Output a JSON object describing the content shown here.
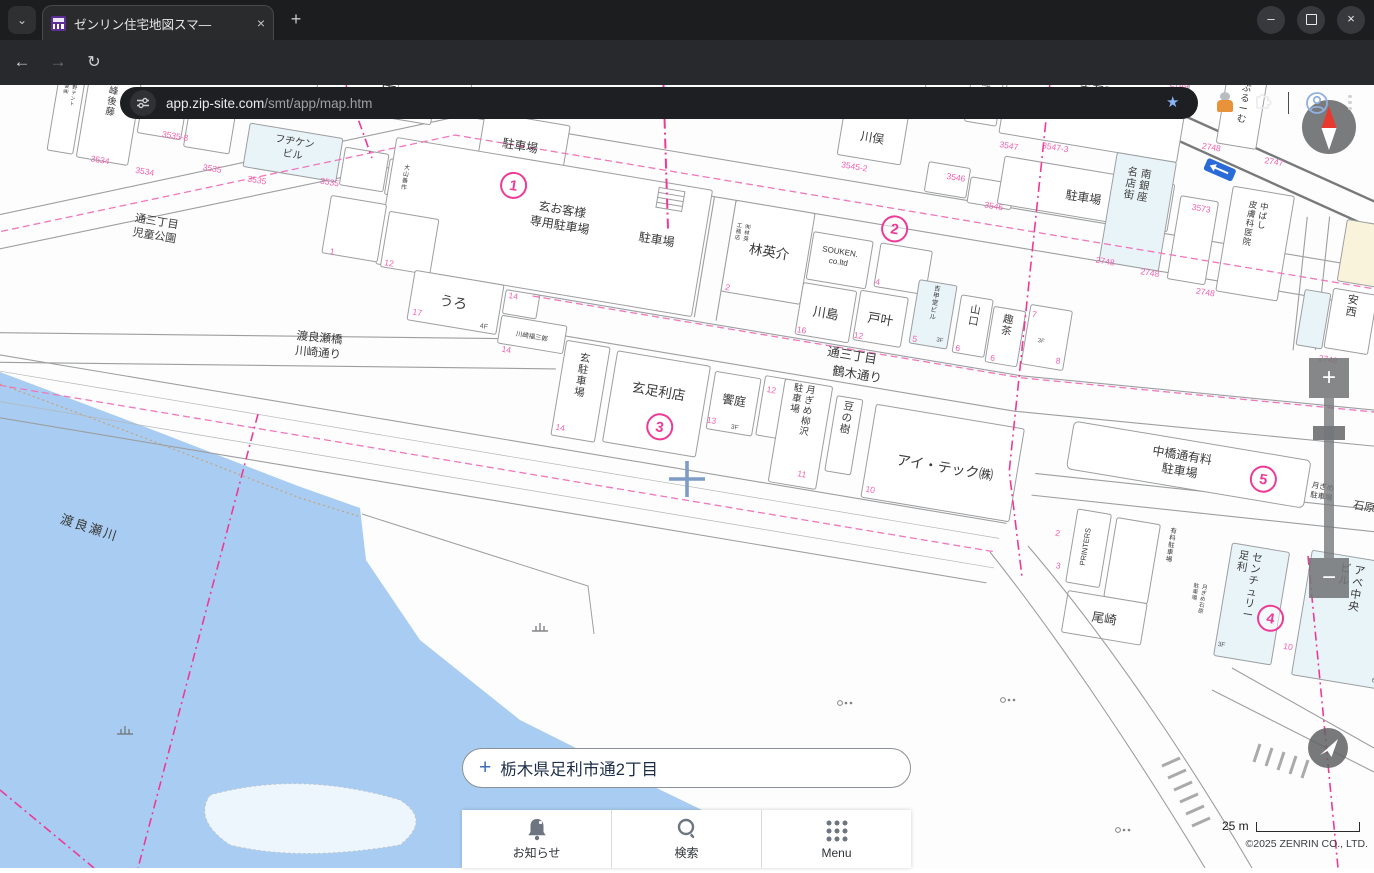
{
  "browser": {
    "tab_title": "ゼンリン住宅地図スマ—",
    "tab_close": "×",
    "new_tab": "+",
    "url_domain": "app.zip-site.com",
    "url_path": "/smt/app/map.htm",
    "window": {
      "minimize": "—",
      "close": "×"
    }
  },
  "search": {
    "plus": "+",
    "address": "栃木県足利市通2丁目"
  },
  "toolbar": {
    "notice": "お知らせ",
    "search": "検索",
    "menu": "Menu"
  },
  "controls": {
    "zoom_in": "+",
    "zoom_out": "−",
    "scale": "25 m",
    "copyright": "©2025 ZENRIN CO., LTD."
  },
  "map": {
    "colors": {
      "parcel": "#f35fae",
      "boundary": "#ee3a97",
      "river": "#a9cdf2",
      "building_blue": "#e9f4f8",
      "building_cream": "#faf3dc",
      "road": "#9c9ea0",
      "crosshair": "#7e9cc6"
    },
    "labels": [
      {
        "t": "三田",
        "x": 321,
        "y": 152,
        "s": 16
      },
      {
        "t": "峰後藤",
        "x": 58,
        "y": 194,
        "s": 9.5,
        "v": 1
      },
      {
        "t": "水野テント\n商会㈱",
        "x": 19,
        "y": 190,
        "s": 5,
        "v": 1
      },
      {
        "t": "フヂケン\nビル",
        "x": 245,
        "y": 214,
        "s": 10
      },
      {
        "t": "大山善作",
        "x": 360,
        "y": 220,
        "s": 6,
        "v": 1
      },
      {
        "t": "通三丁目\n児童公園",
        "x": 122,
        "y": 316,
        "s": 11
      },
      {
        "t": "イシイ",
        "x": 372,
        "y": 146,
        "s": 11
      },
      {
        "t": "3F",
        "x": 402,
        "y": 154,
        "s": 6.5,
        "c": "#555"
      },
      {
        "t": "駐車場",
        "x": 468,
        "y": 182,
        "s": 12
      },
      {
        "t": "玄お客様\n専用駐車場",
        "x": 520,
        "y": 238,
        "s": 12
      },
      {
        "t": "駐車場",
        "x": 618,
        "y": 252,
        "s": 12
      },
      {
        "t": "うろ",
        "x": 428,
        "y": 348,
        "s": 14
      },
      {
        "t": "4F",
        "x": 462,
        "y": 364,
        "s": 7,
        "c": "#555"
      },
      {
        "t": "川崎福三郎",
        "x": 511,
        "y": 366,
        "s": 6.5
      },
      {
        "t": "玄駐車場",
        "x": 567,
        "y": 380,
        "s": 10.5,
        "v": 1
      },
      {
        "t": "林英介",
        "x": 731,
        "y": 246,
        "s": 13.5
      },
      {
        "t": "㈲林英\n工務店",
        "x": 706,
        "y": 222,
        "s": 5.5,
        "v": 1
      },
      {
        "t": "SOUKEN.\nco.ltd",
        "x": 801,
        "y": 232,
        "s": 8
      },
      {
        "t": "川島",
        "x": 797,
        "y": 297,
        "s": 13
      },
      {
        "t": "戸叶",
        "x": 852,
        "y": 294,
        "s": 13
      },
      {
        "t": "吉甲堂ビル",
        "x": 903,
        "y": 252,
        "s": 6.5,
        "v": 1
      },
      {
        "t": "3F",
        "x": 914,
        "y": 302,
        "s": 6,
        "c": "#555"
      },
      {
        "t": "山口",
        "x": 944,
        "y": 268,
        "s": 10.5,
        "v": 1
      },
      {
        "t": "趣茶",
        "x": 978,
        "y": 272,
        "s": 10.5,
        "v": 1
      },
      {
        "t": "3F",
        "x": 1014,
        "y": 286,
        "s": 6,
        "c": "#555"
      },
      {
        "t": "通三丁目",
        "x": 830,
        "y": 334,
        "s": 12.5
      },
      {
        "t": "鶴木通り",
        "x": 838,
        "y": 352,
        "s": 12.5
      },
      {
        "t": "玄足利店",
        "x": 645,
        "y": 402,
        "s": 13.5
      },
      {
        "t": "饗庭",
        "x": 721,
        "y": 398,
        "s": 12
      },
      {
        "t": "月ぎめ柳沢\n駐車場",
        "x": 795,
        "y": 374,
        "s": 9.5,
        "v": 1
      },
      {
        "t": "豆の樹",
        "x": 835,
        "y": 384,
        "s": 10.5,
        "v": 1
      },
      {
        "t": "アイ・テック㈱",
        "x": 940,
        "y": 430,
        "s": 14
      },
      {
        "t": "渡良瀬橋\n川崎通り",
        "x": 302,
        "y": 404,
        "s": 11.5,
        "r": -4
      },
      {
        "t": "JYU",
        "x": 881,
        "y": 44,
        "s": 10
      },
      {
        "t": "赤石屋",
        "x": 918,
        "y": 22,
        "s": 9,
        "v": 1
      },
      {
        "t": "赤石屋\n駐車場",
        "x": 1028,
        "y": 32,
        "s": 12
      },
      {
        "t": "川俣",
        "x": 814,
        "y": 116,
        "s": 12
      },
      {
        "t": "駐車場",
        "x": 1032,
        "y": 140,
        "s": 12
      },
      {
        "t": "ぶるーむ",
        "x": 1175,
        "y": 4,
        "s": 9.5,
        "v": 1
      },
      {
        "t": "南銀座\n名店街",
        "x": 1090,
        "y": 106,
        "s": 10.5,
        "v": 1
      },
      {
        "t": "中ばし\n皮膚科医院",
        "x": 1212,
        "y": 118,
        "s": 8.5,
        "v": 1
      },
      {
        "t": "秋山\n医院",
        "x": 1342,
        "y": 126,
        "s": 8,
        "v": 1
      },
      {
        "t": "安西",
        "x": 1315,
        "y": 196,
        "s": 11,
        "v": 1
      },
      {
        "t": "中橋通有料\n駐車場",
        "x": 1172,
        "y": 378,
        "s": 12
      },
      {
        "t": "月ぎめ\n駐車場",
        "x": 1316,
        "y": 384,
        "s": 7.5
      },
      {
        "t": "石原",
        "x": 1360,
        "y": 398,
        "s": 11
      },
      {
        "t": "PRINTERS",
        "x": 1094,
        "y": 480,
        "s": 7.5,
        "r": -90
      },
      {
        "t": "有料駐車場",
        "x": 1176,
        "y": 452,
        "s": 6.5,
        "v": 1
      },
      {
        "t": "尾崎",
        "x": 1122,
        "y": 552,
        "s": 12.5
      },
      {
        "t": "月ぎめ石原\n駐車場",
        "x": 1216,
        "y": 502,
        "s": 5.5,
        "v": 1
      },
      {
        "t": "センチュリー\n足利",
        "x": 1263,
        "y": 466,
        "s": 10.5,
        "v": 1
      },
      {
        "t": "3F",
        "x": 1242,
        "y": 556,
        "s": 6.5,
        "c": "#555"
      },
      {
        "t": "アベ中央\nビル",
        "x": 1366,
        "y": 462,
        "s": 11,
        "v": 1
      },
      {
        "t": "6F",
        "x": 1400,
        "y": 566,
        "s": 6.5,
        "c": "#555"
      },
      {
        "t": "3F",
        "x": 726,
        "y": 422,
        "s": 6.5,
        "c": "#555"
      }
    ],
    "parcels": [
      {
        "t": "3534",
        "x": 56,
        "y": 264
      },
      {
        "t": "3534",
        "x": 102,
        "y": 268
      },
      {
        "t": "3535-8",
        "x": 126,
        "y": 228
      },
      {
        "t": "3535",
        "x": 168,
        "y": 254
      },
      {
        "t": "3535",
        "x": 214,
        "y": 258
      },
      {
        "t": "3535",
        "x": 286,
        "y": 248
      },
      {
        "t": "3537",
        "x": 728,
        "y": 92
      },
      {
        "t": "3537",
        "x": 822,
        "y": 78
      },
      {
        "t": "3545-2",
        "x": 801,
        "y": 146
      },
      {
        "t": "3546",
        "x": 903,
        "y": 140
      },
      {
        "t": "3546",
        "x": 945,
        "y": 162
      },
      {
        "t": "3547",
        "x": 950,
        "y": 100
      },
      {
        "t": "3547-3",
        "x": 996,
        "y": 94
      },
      {
        "t": "2749",
        "x": 1108,
        "y": 12
      },
      {
        "t": "2748",
        "x": 1150,
        "y": 68
      },
      {
        "t": "2747",
        "x": 1214,
        "y": 72
      },
      {
        "t": "3573",
        "x": 1150,
        "y": 130
      },
      {
        "t": "2748",
        "x": 1064,
        "y": 198
      },
      {
        "t": "2748",
        "x": 1110,
        "y": 202
      },
      {
        "t": "2748",
        "x": 1168,
        "y": 212
      },
      {
        "t": "2748",
        "x": 1300,
        "y": 258
      },
      {
        "t": "2",
        "x": 696,
        "y": 286
      },
      {
        "t": "16",
        "x": 776,
        "y": 316
      },
      {
        "t": "12",
        "x": 833,
        "y": 312
      },
      {
        "t": "4",
        "x": 843,
        "y": 256
      },
      {
        "t": "5",
        "x": 889,
        "y": 306
      },
      {
        "t": "6",
        "x": 933,
        "y": 308
      },
      {
        "t": "6",
        "x": 969,
        "y": 312
      },
      {
        "t": "7",
        "x": 1003,
        "y": 262
      },
      {
        "t": "8",
        "x": 1034,
        "y": 304
      },
      {
        "t": "17",
        "x": 394,
        "y": 362
      },
      {
        "t": "14",
        "x": 486,
        "y": 330
      },
      {
        "t": "14",
        "x": 488,
        "y": 384
      },
      {
        "t": "14",
        "x": 554,
        "y": 452
      },
      {
        "t": "13",
        "x": 702,
        "y": 420
      },
      {
        "t": "12",
        "x": 756,
        "y": 380
      },
      {
        "t": "11",
        "x": 800,
        "y": 458
      },
      {
        "t": "10",
        "x": 870,
        "y": 462
      },
      {
        "t": "10",
        "x": 1308,
        "y": 548
      },
      {
        "t": "2",
        "x": 1062,
        "y": 474
      },
      {
        "t": "3",
        "x": 1068,
        "y": 506
      },
      {
        "t": "1",
        "x": 300,
        "y": 316
      },
      {
        "t": "12",
        "x": 358,
        "y": 318
      }
    ],
    "circled": [
      {
        "n": "1",
        "x": 468,
        "y": 218
      },
      {
        "n": "2",
        "x": 851,
        "y": 198
      },
      {
        "n": "3",
        "x": 652,
        "y": 432
      },
      {
        "n": "4",
        "x": 1286,
        "y": 520
      },
      {
        "n": "5",
        "x": 1256,
        "y": 384
      }
    ],
    "screen_labels": [
      {
        "t": "渡良瀬川",
        "x": 88,
        "y": 532,
        "s": 13,
        "r": 18,
        "ls": 2
      }
    ]
  }
}
